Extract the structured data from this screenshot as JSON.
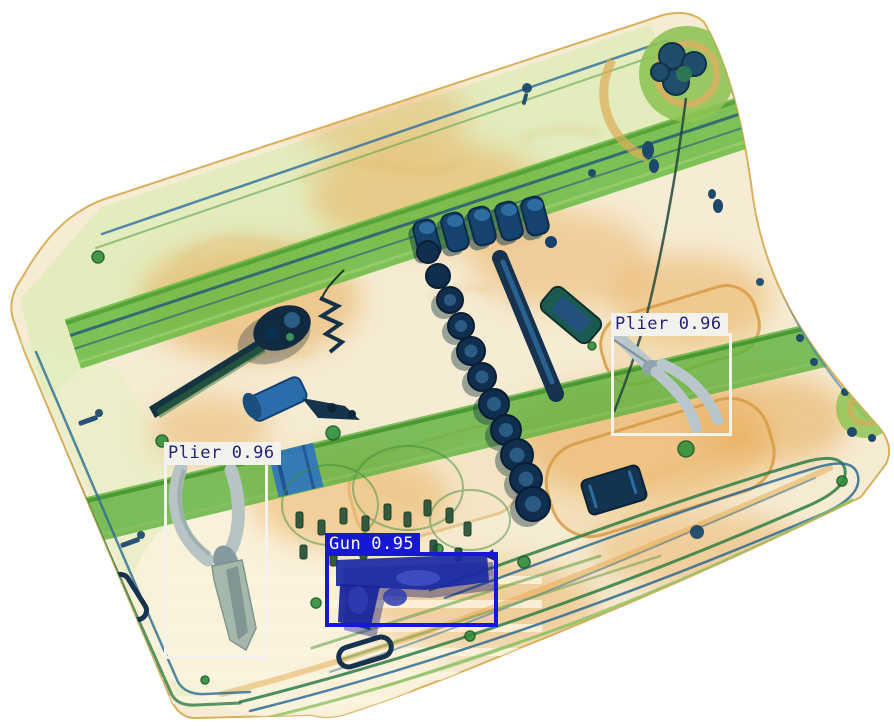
{
  "detections": [
    {
      "label": "Plier",
      "confidence": "0.96",
      "box": {
        "x": 611,
        "y": 333,
        "width": 121,
        "height": 103,
        "border_px": 3
      },
      "colors": {
        "box": "#f4f2ec",
        "label_bg": "#f4f2ec",
        "label_text": "#23237a"
      }
    },
    {
      "label": "Plier",
      "confidence": "0.96",
      "box": {
        "x": 164,
        "y": 462,
        "width": 104,
        "height": 197,
        "border_px": 3
      },
      "colors": {
        "box": "#f4f2ec",
        "label_bg": "#f4f2ec",
        "label_text": "#23237a"
      }
    },
    {
      "label": "Gun",
      "confidence": "0.95",
      "box": {
        "x": 325,
        "y": 552,
        "width": 173,
        "height": 75,
        "border_px": 4
      },
      "colors": {
        "box": "#1717d6",
        "label_bg": "#1717d6",
        "label_text": "#ffffff"
      }
    }
  ],
  "scene_colors": {
    "background": "#ffffff",
    "case_body": "#f5ecd3",
    "case_orange": "#e8a34b",
    "strap_green": "#6cbb45",
    "metal_navy": "#15436e",
    "plier_grey": "#b7c3cc",
    "gun_blue": "#1b2aa3"
  }
}
